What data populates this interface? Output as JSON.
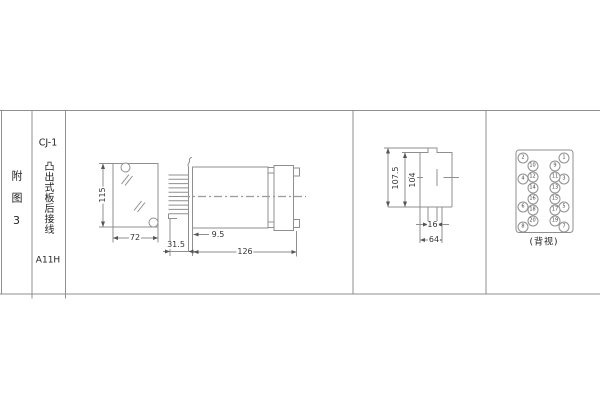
{
  "figure": {
    "label": "附图3"
  },
  "title_block": {
    "model": "CJ-1",
    "mounting_type": "凸出式板后接线",
    "code": "A11H"
  },
  "dims": {
    "v115": "115",
    "v72": "72",
    "v315": "31.5",
    "v95": "9.5",
    "v126": "126",
    "v1075": "107.5",
    "v104": "104",
    "v16": "16",
    "v64": "64"
  },
  "back_view": {
    "label": "(背视)",
    "terminals": [
      {
        "n": "1",
        "x": 564,
        "y": 158
      },
      {
        "n": "2",
        "x": 523,
        "y": 158
      },
      {
        "n": "3",
        "x": 564,
        "y": 179
      },
      {
        "n": "4",
        "x": 523,
        "y": 179
      },
      {
        "n": "5",
        "x": 564,
        "y": 207
      },
      {
        "n": "6",
        "x": 523,
        "y": 207
      },
      {
        "n": "7",
        "x": 564,
        "y": 226.5
      },
      {
        "n": "8",
        "x": 523,
        "y": 226.5
      },
      {
        "n": "9",
        "x": 555,
        "y": 165.5
      },
      {
        "n": "10",
        "x": 532.5,
        "y": 165.5
      },
      {
        "n": "11",
        "x": 555,
        "y": 176.5
      },
      {
        "n": "12",
        "x": 532.5,
        "y": 176.5
      },
      {
        "n": "13",
        "x": 555,
        "y": 187.5
      },
      {
        "n": "14",
        "x": 532.5,
        "y": 187.5
      },
      {
        "n": "15",
        "x": 555,
        "y": 198.5
      },
      {
        "n": "16",
        "x": 532.5,
        "y": 198.5
      },
      {
        "n": "17",
        "x": 555,
        "y": 209.5
      },
      {
        "n": "18",
        "x": 532.5,
        "y": 209.5
      },
      {
        "n": "19",
        "x": 555,
        "y": 220.5
      },
      {
        "n": "20",
        "x": 532.5,
        "y": 220.5
      }
    ]
  },
  "colors": {
    "line": "#8f8f8f",
    "dim_text": "#555555",
    "text": "#333333",
    "background": "#ffffff"
  }
}
